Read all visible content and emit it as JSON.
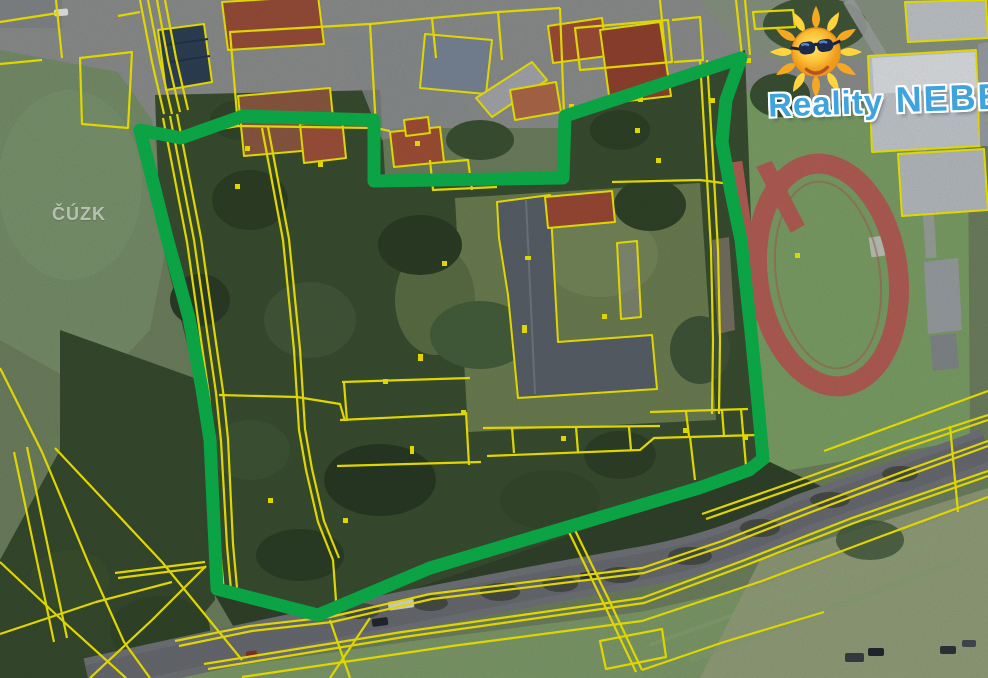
{
  "title": "Aerial cadastral map with highlighted property boundary",
  "watermark": {
    "label": "ČÚZK"
  },
  "logo": {
    "brand_first": "Reality",
    "brand_second": "NEBE",
    "icon": "sun-with-sunglasses-icon"
  },
  "map": {
    "description": "satellite orthophoto with yellow cadastral parcel lines, green highlighted parcel boundary, sports track, road and buildings",
    "colors": {
      "parcel_line": "#f6ec00",
      "highlight_green": "#0db44c",
      "logo_blue": "#3fa3dd",
      "field_green": "#76896a",
      "forest_green": "#3a4f31",
      "track_red": "#b55f56",
      "road_gray": "#75787c",
      "roof_red": "#9c4f38",
      "roof_slate": "#59616a",
      "building_gray": "#c2c7cb"
    },
    "highlight_stroke_width": 13,
    "highlight_polygon": [
      [
        140,
        130
      ],
      [
        181,
        138
      ],
      [
        243,
        116
      ],
      [
        374,
        120
      ],
      [
        374,
        181
      ],
      [
        563,
        178
      ],
      [
        565,
        116
      ],
      [
        741,
        58
      ],
      [
        726,
        100
      ],
      [
        722,
        142
      ],
      [
        731,
        192
      ],
      [
        741,
        240
      ],
      [
        751,
        332
      ],
      [
        758,
        404
      ],
      [
        763,
        459
      ],
      [
        749,
        470
      ],
      [
        699,
        488
      ],
      [
        430,
        568
      ],
      [
        318,
        615
      ],
      [
        217,
        589
      ],
      [
        210,
        440
      ],
      [
        202,
        389
      ],
      [
        189,
        318
      ],
      [
        167,
        238
      ]
    ]
  }
}
